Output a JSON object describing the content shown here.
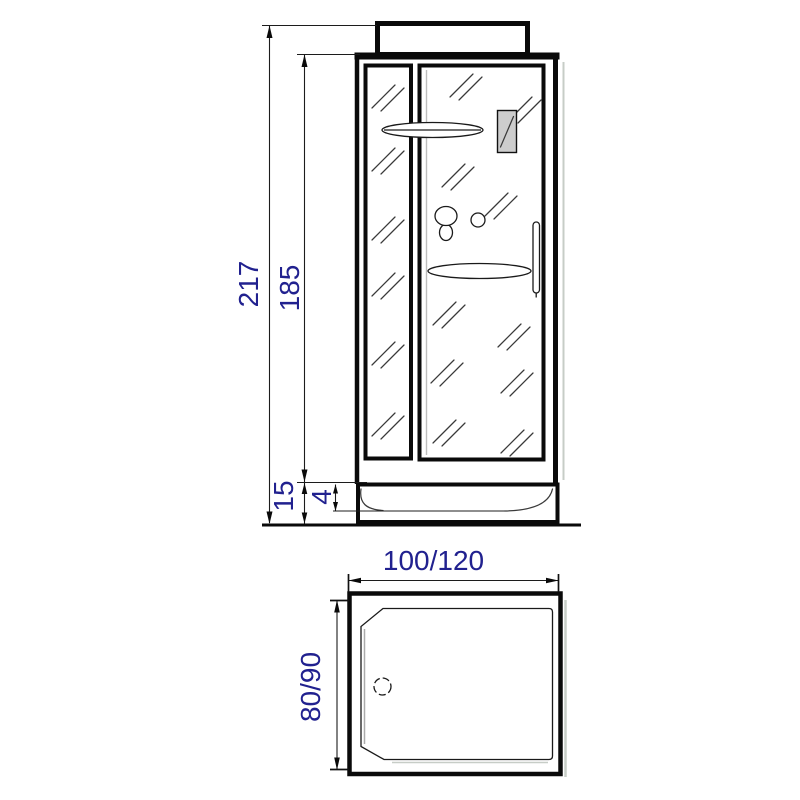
{
  "drawing": {
    "front_view": {
      "dim_total_height": "217",
      "dim_glass_height": "185",
      "dim_tray_height": "15",
      "dim_tray_rim_height": "4"
    },
    "top_view": {
      "dim_width": "100/120",
      "dim_depth": "80/90"
    },
    "colors": {
      "line": "#0a0a0a",
      "dimension_text": "#21218f",
      "panel_shade": "#cdcdcd",
      "shadow": "#c7cdc7",
      "background": "#ffffff"
    }
  }
}
